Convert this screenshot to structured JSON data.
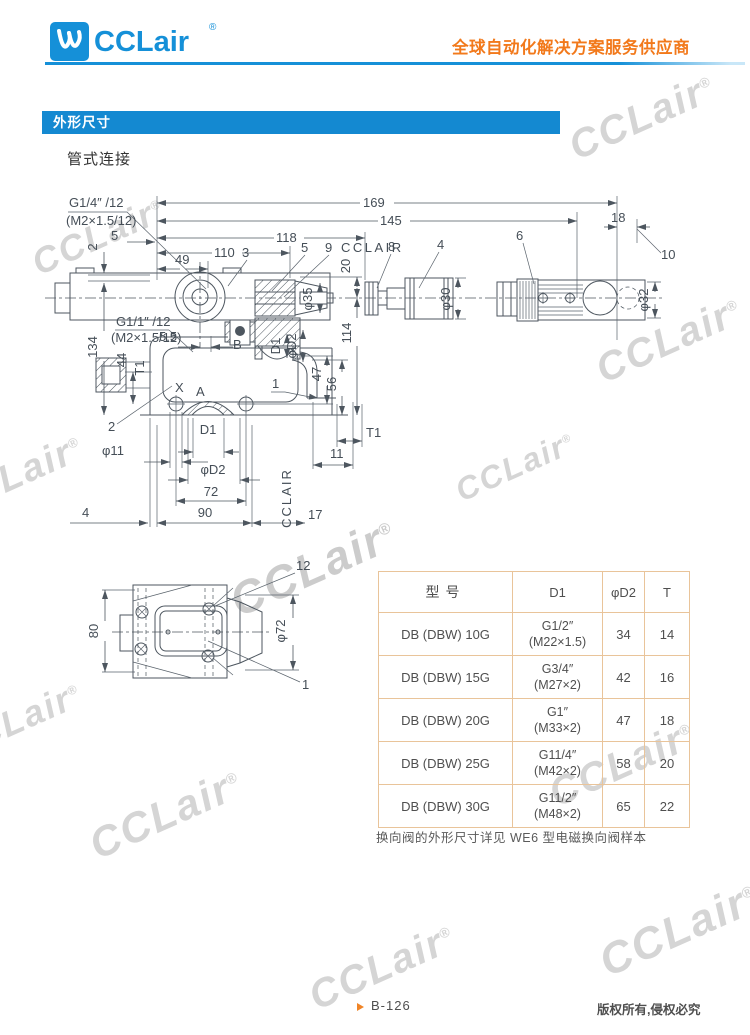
{
  "header": {
    "logo_text": "CCLair",
    "logo_reg": "®",
    "tagline": "全球自动化解决方案服务供应商"
  },
  "section": {
    "title": "外形尺寸",
    "subtitle": "管式连接"
  },
  "drawing": {
    "port_label_top": "G1/4″ /12",
    "port_thread_top": "(M2×1.5/12)",
    "dim_5_top": "5",
    "dim_2_left": "2",
    "dim_169": "169",
    "dim_145": "145",
    "dim_118": "118",
    "dim_110": "110",
    "dim_49": "49",
    "part_3": "3",
    "part_5": "5",
    "part_9": "9",
    "cclair_label": "CCLAIR",
    "part_8": "8",
    "part_4": "4",
    "part_6": "6",
    "dim_18": "18",
    "part_10": "10",
    "dim_20": "20",
    "dim_phi35": "φ35",
    "dim_phi30": "φ30",
    "dim_phi32": "φ32",
    "dim_134": "134",
    "port_label_left": "G1/1″ /12",
    "port_thread_left": "(M2×1.5/12)",
    "dim_5_5": "5.5",
    "dim_44": "44",
    "label_T1_left": "T1",
    "label_X": "X",
    "label_A": "A",
    "label_B": "B",
    "dim_D1_small": "D1",
    "dim_phiD2_small": "φD2",
    "dim_114": "114",
    "dim_47": "47",
    "dim_56": "56",
    "part_1_mid": "1",
    "part_2_bottom": "2",
    "dim_phi11": "φ11",
    "dim_D1": "D1",
    "label_T1_bottom": "T1",
    "dim_11": "11",
    "dim_phiD2": "φD2",
    "dim_72": "72",
    "dim_90": "90",
    "dim_17": "17",
    "dim_4": "4",
    "cclair_vertical": "CCLAIR",
    "bottom_view": {
      "part_12": "12",
      "dim_80": "80",
      "dim_phi72": "φ72",
      "part_1": "1"
    }
  },
  "table": {
    "headers": [
      "型号",
      "D1",
      "φD2",
      "T"
    ],
    "rows": [
      {
        "model": "DB (DBW) 10G",
        "d1a": "G1/2″",
        "d1b": "(M22×1.5)",
        "d2": "34",
        "t": "14"
      },
      {
        "model": "DB (DBW) 15G",
        "d1a": "G3/4″",
        "d1b": "(M27×2)",
        "d2": "42",
        "t": "16"
      },
      {
        "model": "DB (DBW) 20G",
        "d1a": "G1″",
        "d1b": "(M33×2)",
        "d2": "47",
        "t": "18"
      },
      {
        "model": "DB (DBW) 25G",
        "d1a": "G11/4″",
        "d1b": "(M42×2)",
        "d2": "58",
        "t": "20"
      },
      {
        "model": "DB (DBW) 30G",
        "d1a": "G11/2″",
        "d1b": "(M48×2)",
        "d2": "65",
        "t": "22"
      }
    ]
  },
  "note": "换向阀的外形尺寸详见 WE6 型电磁换向阀样本",
  "footer": {
    "page": "B-126",
    "copyright": "版权所有,侵权必究"
  },
  "watermark": {
    "text": "CCLair",
    "reg": "®"
  },
  "colors": {
    "brand_blue": "#1590d8",
    "bar_blue": "#1489d1",
    "accent_orange": "#f2791b",
    "table_border": "#e9c49a",
    "line_color": "#4d565f"
  }
}
